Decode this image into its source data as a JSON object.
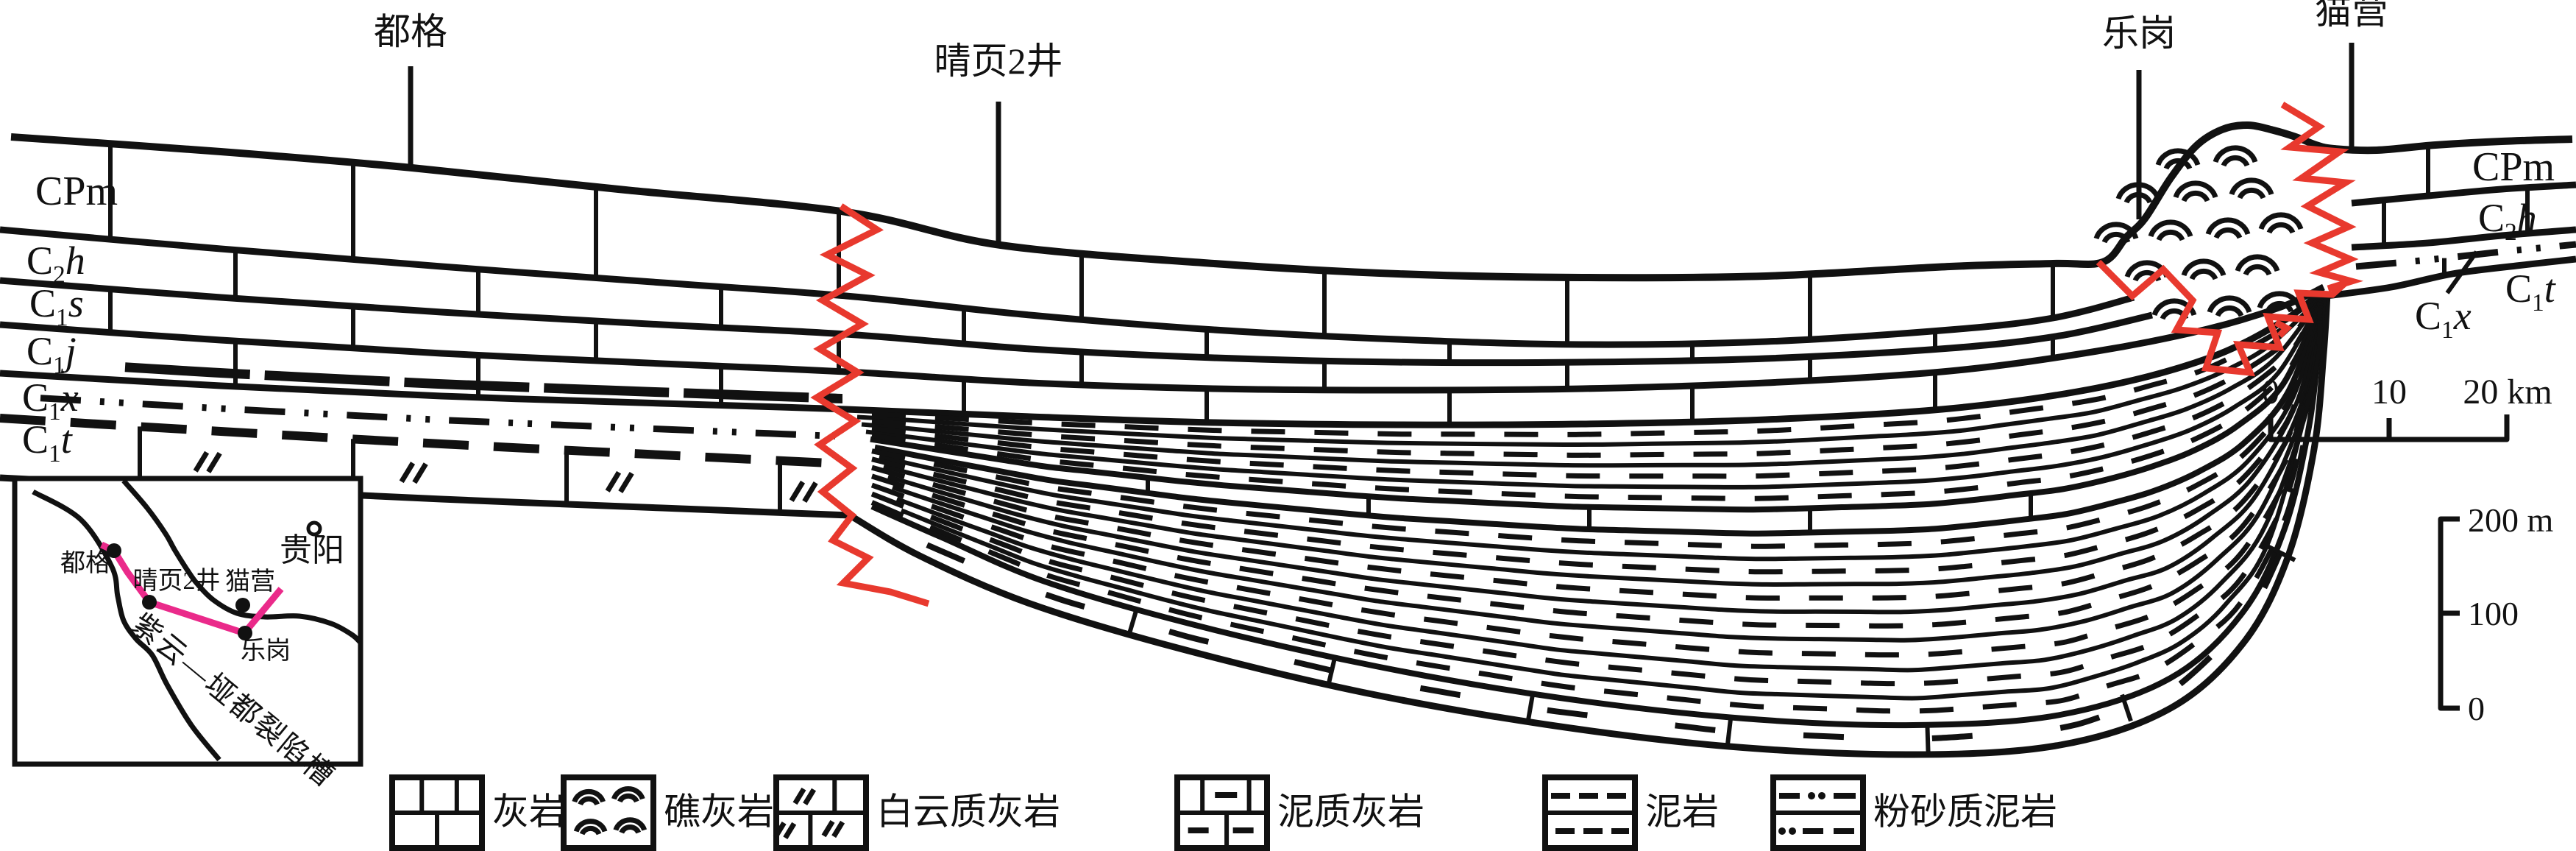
{
  "colors": {
    "ink": "#111111",
    "fault_red": "#e8392e",
    "section_line_pink": "#ea2a8a",
    "paper": "#ffffff"
  },
  "section": {
    "locations": [
      {
        "id": "duge",
        "label": "都格"
      },
      {
        "id": "qingye2-well",
        "label": "晴页2井"
      },
      {
        "id": "legang",
        "label": "乐岗"
      },
      {
        "id": "maoying",
        "label": "猫营"
      }
    ],
    "strata_labels_left": [
      {
        "id": "CPm",
        "text": "CPm"
      },
      {
        "id": "C2h",
        "pre": "C",
        "sub": "2",
        "post": "h"
      },
      {
        "id": "C1s",
        "pre": "C",
        "sub": "1",
        "post": "s"
      },
      {
        "id": "C1j",
        "pre": "C",
        "sub": "1",
        "post": "j"
      },
      {
        "id": "C1x",
        "pre": "C",
        "sub": "1",
        "post": "x"
      },
      {
        "id": "C1t",
        "pre": "C",
        "sub": "1",
        "post": "t"
      }
    ],
    "strata_labels_right": [
      {
        "id": "CPm",
        "text": "CPm"
      },
      {
        "id": "C2h",
        "pre": "C",
        "sub": "2",
        "post": "h"
      },
      {
        "id": "C1x",
        "pre": "C",
        "sub": "1",
        "post": "x"
      },
      {
        "id": "C1t",
        "pre": "C",
        "sub": "1",
        "post": "t"
      }
    ]
  },
  "scales": {
    "horizontal": {
      "tick0": "0",
      "tick1": "10",
      "tick2": "20 km"
    },
    "vertical": {
      "tick0": "200 m",
      "tick1": "100",
      "tick2": "0"
    }
  },
  "inset_map": {
    "city": "贵阳",
    "places": [
      {
        "id": "duge",
        "label": "都格"
      },
      {
        "id": "qingye2-well",
        "label": "晴页2井"
      },
      {
        "id": "maoying",
        "label": "猫营"
      },
      {
        "id": "legang",
        "label": "乐岗"
      }
    ],
    "trough": "紫云—垭都裂陷槽"
  },
  "legend": {
    "items": [
      {
        "id": "limestone",
        "label": "灰岩"
      },
      {
        "id": "reef-limestone",
        "label": "礁灰岩"
      },
      {
        "id": "dolomitic-limestone",
        "label": "白云质灰岩"
      },
      {
        "id": "argillaceous-limestone",
        "label": "泥质灰岩"
      },
      {
        "id": "mudstone",
        "label": "泥岩"
      },
      {
        "id": "silty-mudstone",
        "label": "粉砂质泥岩"
      }
    ]
  }
}
